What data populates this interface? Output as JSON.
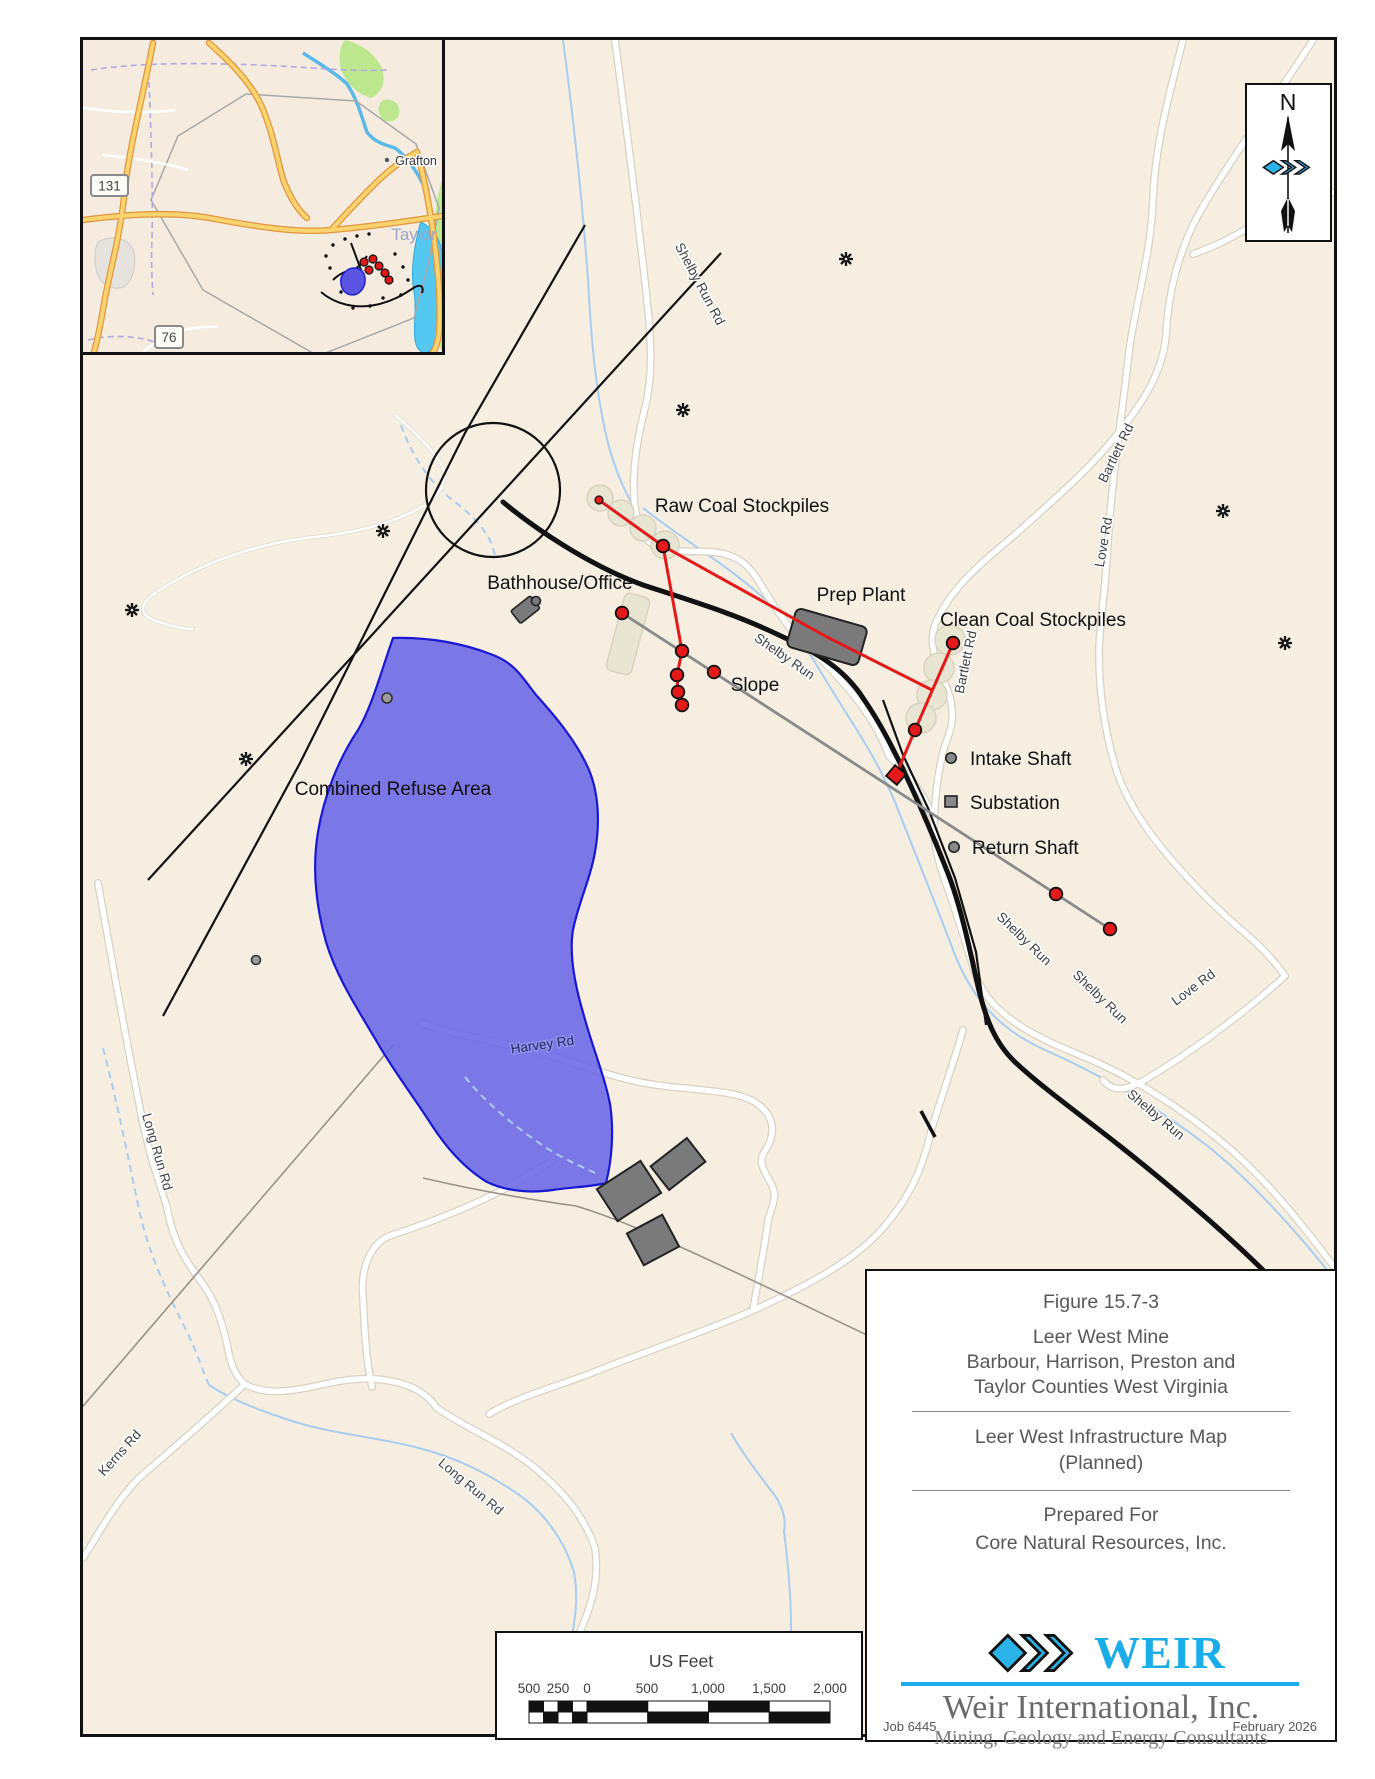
{
  "colors": {
    "accent_cyan": "#1badea",
    "refuse_blue": "#6662e8",
    "marker_red": "#e41a1a"
  },
  "inset": {
    "town_label": "Grafton",
    "county_label": "Taylor",
    "route_shield_1": "131",
    "route_shield_2": "76"
  },
  "north_arrow": {
    "label": "N"
  },
  "site_labels": {
    "raw_coal": "Raw Coal Stockpiles",
    "bathhouse": "Bathhouse/Office",
    "prep_plant": "Prep Plant",
    "clean_coal": "Clean Coal Stockpiles",
    "slope": "Slope",
    "intake_shaft": "Intake Shaft",
    "substation": "Substation",
    "return_shaft": "Return Shaft",
    "refuse_area": "Combined Refuse Area"
  },
  "road_labels": {
    "shelby_run_rd": "Shelby Run Rd",
    "bartlett_rd_upper": "Bartlett Rd",
    "bartlett_rd_lower": "Bartlett Rd",
    "love_rd_upper": "Love Rd",
    "love_rd_lower": "Love Rd",
    "shelby_run_stream_1": "Shelby Run",
    "shelby_run_stream_2": "Shelby Run",
    "shelby_run_stream_3": "Shelby Run",
    "shelby_run_stream_4": "Shelby Run",
    "long_run_rd_upper": "Long Run Rd",
    "long_run_rd_lower": "Long Run Rd",
    "kerns_rd": "Kerns Rd",
    "harvey_rd": "Harvey Rd"
  },
  "scale_bar": {
    "title": "US Feet",
    "ticks": [
      "500",
      "250",
      "0",
      "500",
      "1,000",
      "1,500",
      "2,000"
    ]
  },
  "title_block": {
    "figure_no": "Figure 15.7-3",
    "mine_name": "Leer West Mine",
    "counties_line1": "Barbour, Harrison, Preston and",
    "counties_line2": "Taylor Counties West Virginia",
    "map_title_line1": "Leer West Infrastructure Map",
    "map_title_line2": "(Planned)",
    "prepared_for": "Prepared For",
    "client": "Core Natural Resources, Inc.",
    "logo_word": "WEIR",
    "company": "Weir International, Inc.",
    "tagline": "Mining, Geology and Energy Consultants",
    "job_no": "Job 6445",
    "date": "February 2026"
  }
}
